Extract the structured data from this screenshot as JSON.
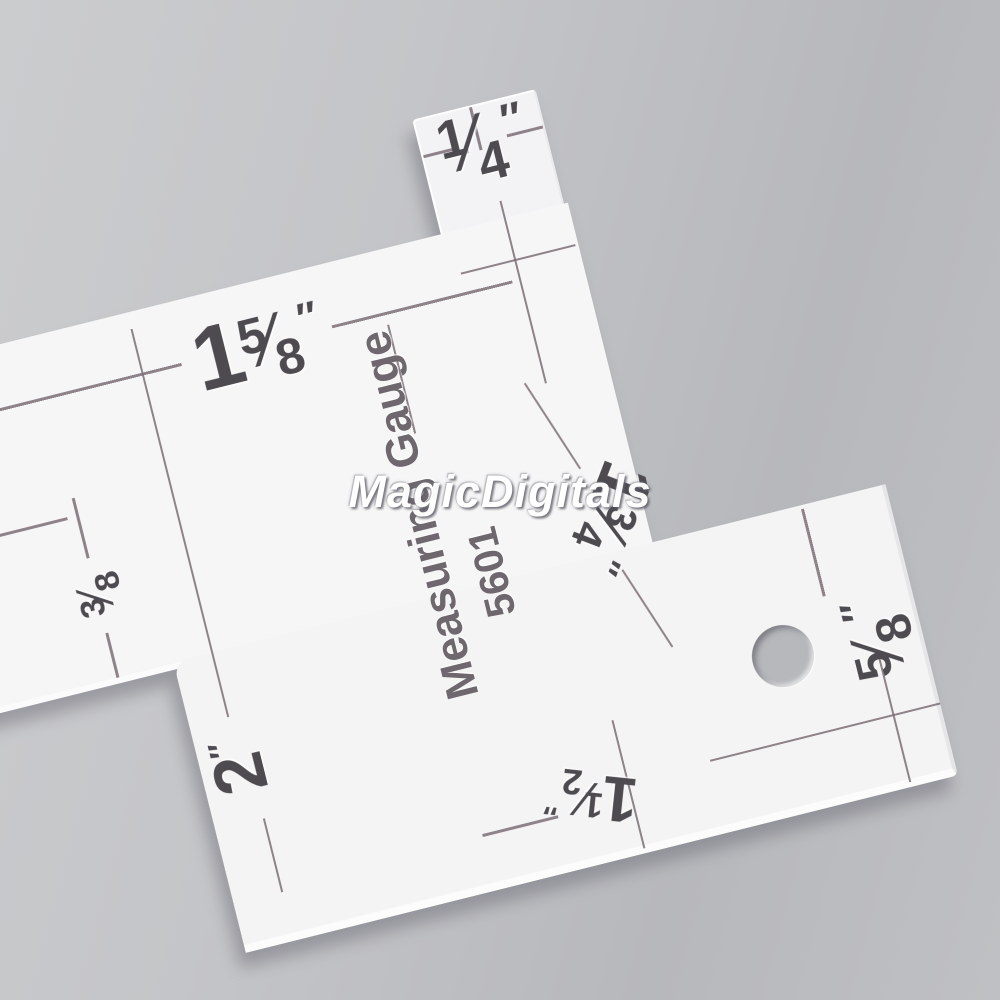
{
  "labels_on_tool": {
    "brand": "Measuring Gauge",
    "model": "5601"
  },
  "marks": {
    "frac_slash": "⁄",
    "quarter": {
      "num": "1",
      "den": "4",
      "unit": "″"
    },
    "one_five_eighths": {
      "whole": "1",
      "num": "5",
      "den": "8",
      "unit": "″"
    },
    "three_eighths": {
      "num": "3",
      "den": "8"
    },
    "two_inches": {
      "whole": "2",
      "unit": "″"
    },
    "one_three_quarters": {
      "whole": "1",
      "num": "3",
      "den": "4",
      "unit": "″"
    },
    "five_eighths": {
      "num": "5",
      "den": "8",
      "unit": "″"
    },
    "one_and_a_half": {
      "whole": "1",
      "num": "1",
      "den": "2",
      "unit": "″"
    }
  },
  "watermark": {
    "text": "MagicDigitals",
    "color": "#ffffff"
  },
  "colors": {
    "background": "#c3c4c7",
    "background_dark": "#b5b6ba",
    "acrylic": "#f6f5f6",
    "print_line": "#7d7178",
    "print_digit": "#4d4a50",
    "shadow": "#8e8e96"
  }
}
